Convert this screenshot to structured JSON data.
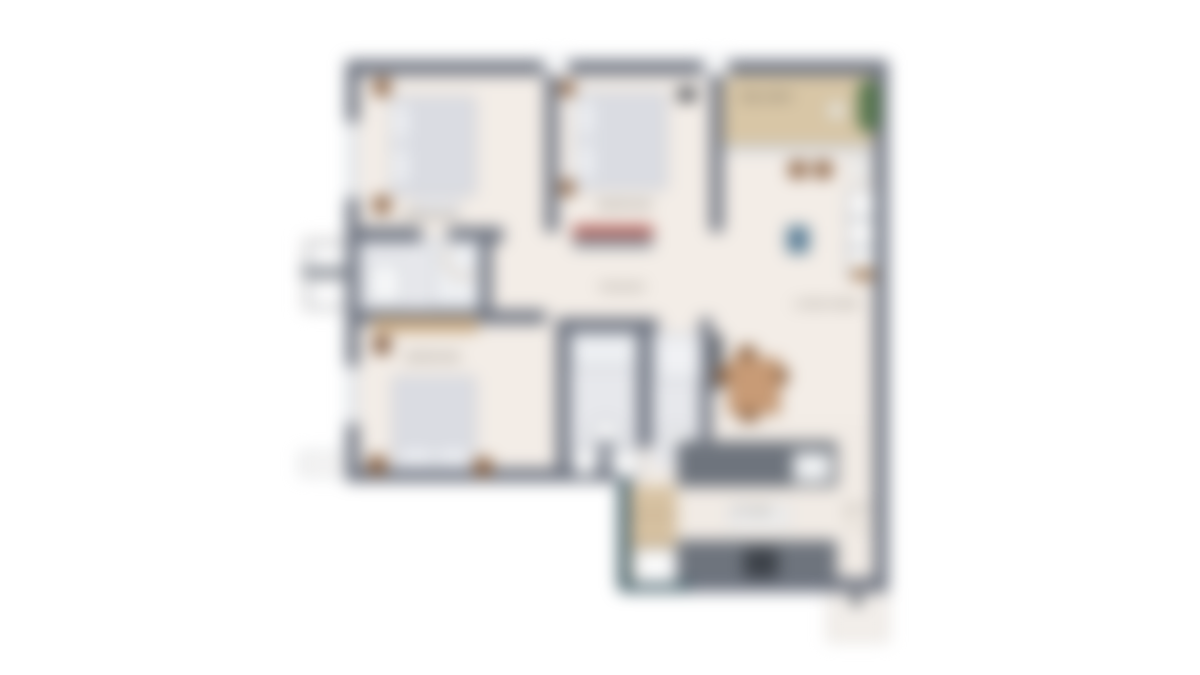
{
  "image_type": "blurred residential apartment floor plan, top-down view",
  "colors": {
    "wall": "#6d7380",
    "wall_teal": "#47636d",
    "floor_cream": "#f3ede7",
    "bathroom_tile": "#e7e8ec",
    "balcony_deck": "#d8c6a6",
    "bed_gray": "#d6d8df",
    "furniture_wood": "#8a6141",
    "dresser_light_wood": "#c9a87e",
    "kitchen_counter": "#6e747d",
    "appliance_dark": "#3c4148",
    "rug_blue": "#5a7e97",
    "books_red": "#b05048",
    "plant_green": "#55754d",
    "background": "#ffffff"
  },
  "floor_plan": {
    "rooms": {
      "bedroom_1": {
        "label": "BEDROOM",
        "furniture": [
          "double-bed",
          "nightstand",
          "nightstand",
          "bench"
        ]
      },
      "bedroom_2": {
        "label": "BEDROOM",
        "furniture": [
          "double-bed",
          "nightstand",
          "dresser",
          "ac-unit"
        ]
      },
      "bedroom_3": {
        "label": "BEDROOM",
        "furniture": [
          "double-bed",
          "nightstand",
          "nightstand",
          "wardrobe",
          "dresser"
        ]
      },
      "bathroom_1": {
        "furniture": [
          "vanity",
          "shower"
        ]
      },
      "bathroom_2": {
        "furniture": [
          "shower",
          "washbasin",
          "toilet",
          "toilet"
        ]
      },
      "bathroom_3": {
        "furniture": [
          "bathtub",
          "washbasin"
        ]
      },
      "living_dining": {
        "label": "LIVING ROOM",
        "furniture": [
          "dining-table",
          "chairs",
          "blue-rug",
          "shelving",
          "tv-unit"
        ]
      },
      "balcony": {
        "label": "BALCONY",
        "furniture": [
          "plant",
          "side-table"
        ]
      },
      "kitchen": {
        "label": "KITCHEN",
        "furniture": [
          "counter",
          "sink",
          "cooktop",
          "refrigerator",
          "pantry"
        ]
      },
      "passage": {
        "label": "PASSAGE"
      },
      "entry": {
        "label": "ENTRY"
      },
      "utility_ledge": {
        "furniture": [
          "ac-unit",
          "ac-unit"
        ]
      }
    }
  }
}
